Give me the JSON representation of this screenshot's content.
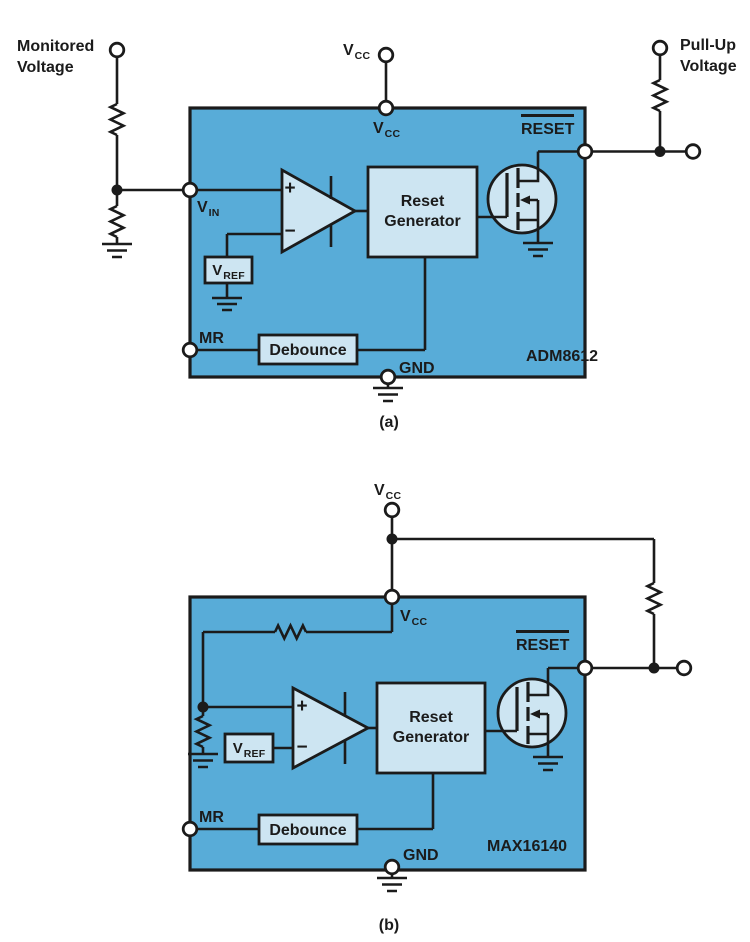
{
  "colors": {
    "chip_fill": "#58ACD8",
    "block_fill": "#CDE5F2",
    "line": "#1B1B1B",
    "background": "#FFFFFF"
  },
  "diagram_a": {
    "chip_name": "ADM8612",
    "caption": "(a)",
    "monitored_voltage": {
      "line1": "Monitored",
      "line2": "Voltage"
    },
    "pull_up_voltage": {
      "line1": "Pull-Up",
      "line2": "Voltage"
    },
    "vcc_supply": {
      "main": "V",
      "sub": "CC"
    },
    "pins": {
      "vcc": {
        "main": "V",
        "sub": "CC"
      },
      "vin": {
        "main": "V",
        "sub": "IN"
      },
      "reset": "RESET",
      "mr": "MR",
      "gnd": "GND"
    },
    "blocks": {
      "reset_generator": {
        "line1": "Reset",
        "line2": "Generator"
      },
      "debounce": "Debounce",
      "vref": {
        "main": "V",
        "sub": "REF"
      }
    },
    "comparator": {
      "plus": "+",
      "minus": "−"
    }
  },
  "diagram_b": {
    "chip_name": "MAX16140",
    "caption": "(b)",
    "vcc_supply": {
      "main": "V",
      "sub": "CC"
    },
    "pins": {
      "vcc": {
        "main": "V",
        "sub": "CC"
      },
      "reset": "RESET",
      "mr": "MR",
      "gnd": "GND"
    },
    "blocks": {
      "reset_generator": {
        "line1": "Reset",
        "line2": "Generator"
      },
      "debounce": "Debounce",
      "vref": {
        "main": "V",
        "sub": "REF"
      }
    },
    "comparator": {
      "plus": "+",
      "minus": "−"
    }
  }
}
